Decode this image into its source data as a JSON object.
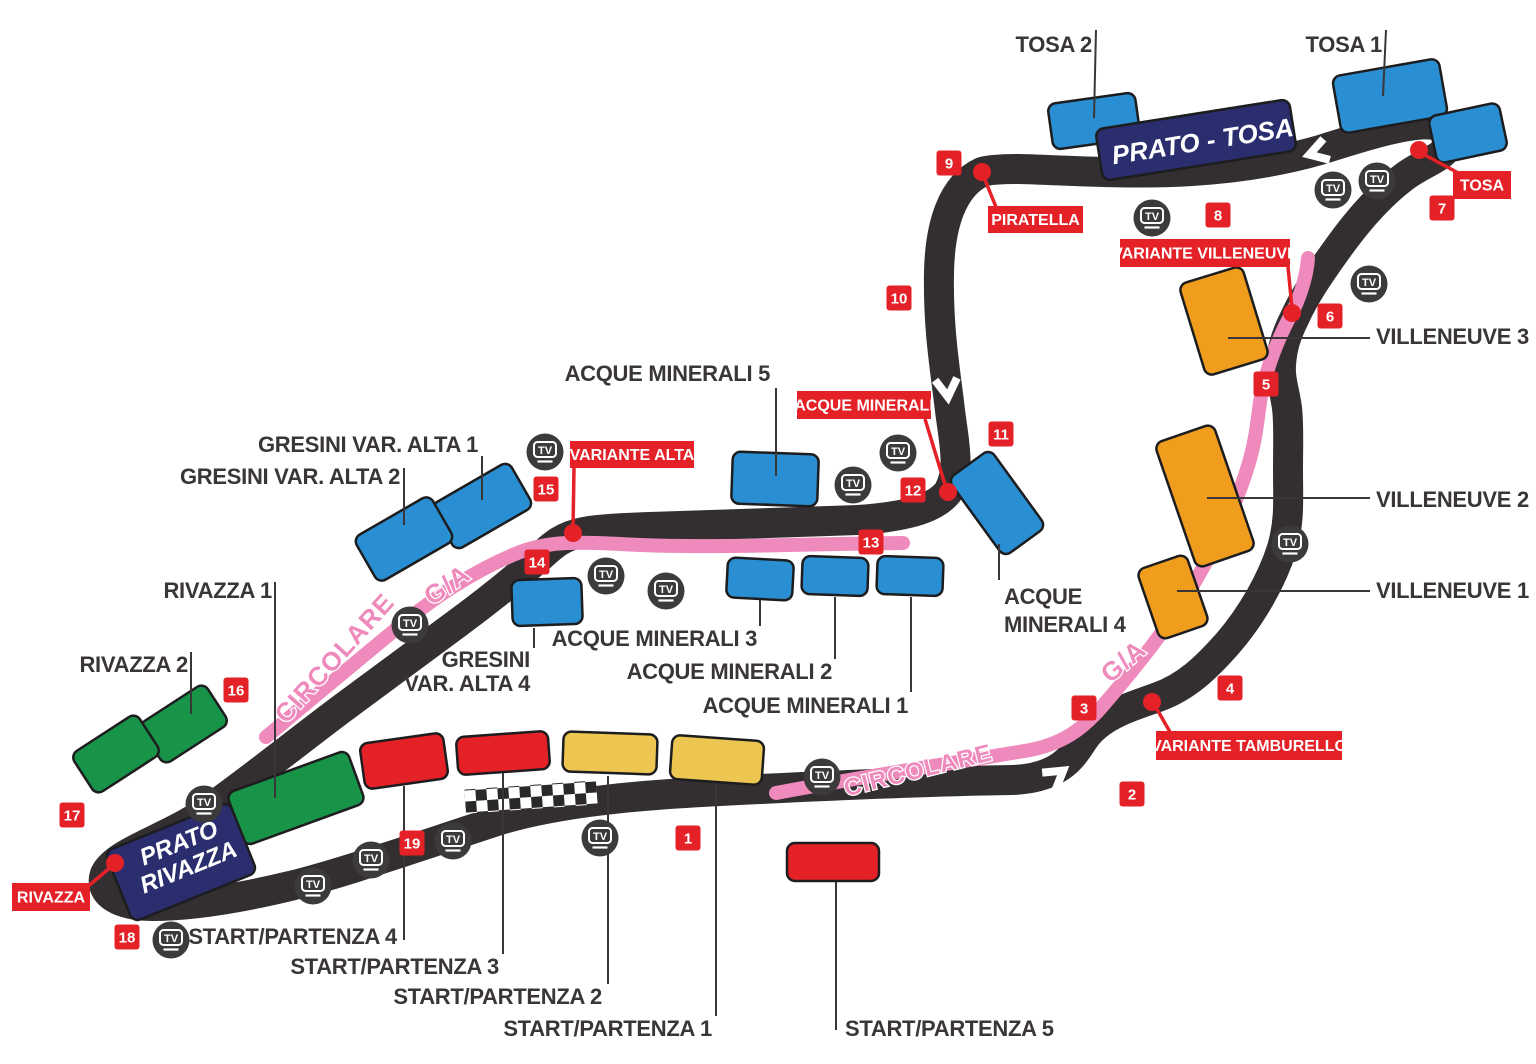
{
  "map": {
    "name": "race-circuit-grandstand-map",
    "background": "#ffffff"
  },
  "colors": {
    "track": "#332f30",
    "walkway_pink": "#ef8abc",
    "marker_red": "#e42127",
    "label_dark": "#3a3637",
    "stand_blue": "#2a8fd2",
    "stand_navy": "#2a2e6e",
    "stand_orange": "#f09d1e",
    "stand_green": "#189448",
    "stand_red": "#e42127",
    "stand_yellow": "#edc652",
    "tv_dark": "#3d3a3b",
    "white": "#ffffff"
  },
  "corner_flags": [
    {
      "id": "piratella",
      "label": "PIRATELLA"
    },
    {
      "id": "variante-villeneuve",
      "label": "VARIANTE VILLENEUVE"
    },
    {
      "id": "tosa",
      "label": "TOSA"
    },
    {
      "id": "acque-minerali",
      "label": "ACQUE MINERALI"
    },
    {
      "id": "variante-alta",
      "label": "VARIANTE ALTA"
    },
    {
      "id": "variante-tamburello",
      "label": "VARIANTE TAMBURELLO"
    },
    {
      "id": "rivazza",
      "label": "RIVAZZA"
    }
  ],
  "sector_markers": [
    "1",
    "2",
    "3",
    "4",
    "5",
    "6",
    "7",
    "8",
    "9",
    "10",
    "11",
    "12",
    "13",
    "14",
    "15",
    "16",
    "17",
    "18",
    "19"
  ],
  "grandstands": [
    {
      "id": "tosa-2",
      "color": "blue",
      "label": "TOSA 2"
    },
    {
      "id": "tosa-1",
      "color": "blue",
      "label": "TOSA 1"
    },
    {
      "id": "tosa-annex",
      "color": "blue",
      "label": ""
    },
    {
      "id": "prato-tosa",
      "color": "navy",
      "label_inside": [
        "PRATO - TOSA"
      ]
    },
    {
      "id": "villeneuve-3",
      "color": "orange",
      "label": "VILLENEUVE 3"
    },
    {
      "id": "villeneuve-2",
      "color": "orange",
      "label": "VILLENEUVE 2"
    },
    {
      "id": "villeneuve-1",
      "color": "orange",
      "label": "VILLENEUVE 1"
    },
    {
      "id": "acque-minerali-5",
      "color": "blue",
      "label": "ACQUE MINERALI 5"
    },
    {
      "id": "acque-minerali-4",
      "color": "blue",
      "label_lines": [
        "ACQUE",
        "MINERALI 4"
      ]
    },
    {
      "id": "acque-minerali-3",
      "color": "blue",
      "label": "ACQUE MINERALI 3"
    },
    {
      "id": "acque-minerali-2",
      "color": "blue",
      "label": "ACQUE MINERALI 2"
    },
    {
      "id": "acque-minerali-1",
      "color": "blue",
      "label": "ACQUE MINERALI 1"
    },
    {
      "id": "gresini-var-alta-1",
      "color": "blue",
      "label": "GRESINI VAR. ALTA 1"
    },
    {
      "id": "gresini-var-alta-2",
      "color": "blue",
      "label": "GRESINI VAR. ALTA 2"
    },
    {
      "id": "gresini-var-alta-4",
      "color": "blue",
      "label_lines": [
        "GRESINI",
        "VAR. ALTA 4"
      ]
    },
    {
      "id": "rivazza-2",
      "color": "green",
      "label": "RIVAZZA 2"
    },
    {
      "id": "rivazza-2b",
      "color": "green",
      "label": ""
    },
    {
      "id": "rivazza-1",
      "color": "green",
      "label": "RIVAZZA 1"
    },
    {
      "id": "prato-rivazza",
      "color": "navy",
      "label_inside": [
        "PRATO",
        "RIVAZZA"
      ]
    },
    {
      "id": "start-partenza-4",
      "color": "red",
      "label": "START/PARTENZA 4"
    },
    {
      "id": "start-partenza-3",
      "color": "red",
      "label": "START/PARTENZA 3"
    },
    {
      "id": "start-partenza-2",
      "color": "yellow",
      "label": "START/PARTENZA 2"
    },
    {
      "id": "start-partenza-1",
      "color": "yellow",
      "label": "START/PARTENZA 1"
    },
    {
      "id": "start-partenza-5",
      "color": "red",
      "label": "START/PARTENZA 5"
    }
  ],
  "walkway_labels": {
    "circolare": "CIRCOLARE",
    "ga": "G/A"
  },
  "tv_icon": {
    "label": "TV",
    "count": 18
  }
}
